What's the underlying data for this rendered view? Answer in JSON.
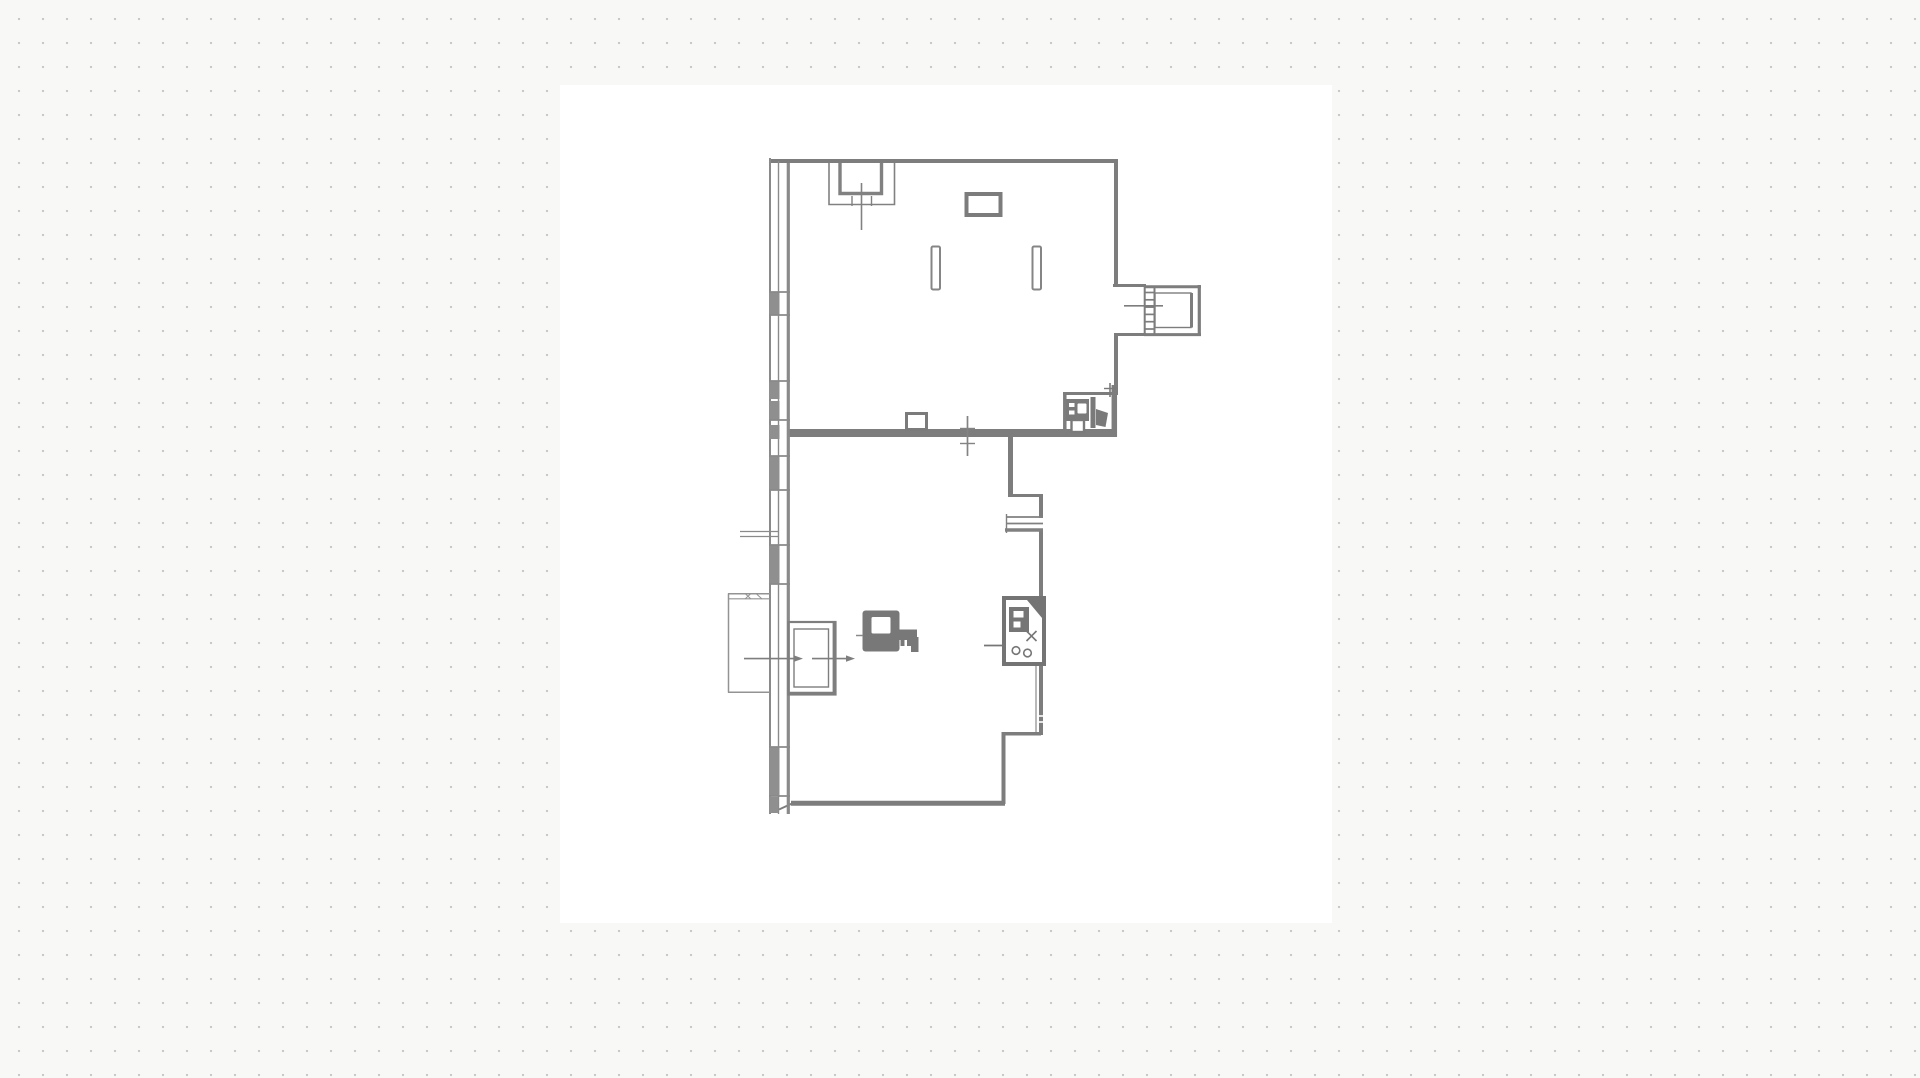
{
  "app": {
    "type": "design-canvas",
    "description": "Dotted-grid design canvas displaying a scanned architectural floor plan",
    "background_color": "#f8f8f7",
    "dot_color": "#c9c9c9",
    "dot_spacing_px": 24,
    "paper_color": "#ffffff",
    "line_color": "#828282"
  },
  "floor_plan": {
    "label": "Floor plan drawing of a two-room unit: upper hall with shaft, two columns and WC, lower room with kitchen unit, closet, toilet symbol, left window wall with glazing, left and right balcony boxes, vent grille and dimension markers",
    "rooms": [
      {
        "name": "upper-hall"
      },
      {
        "name": "lower-room"
      }
    ],
    "elements": [
      {
        "name": "window-wall",
        "side": "left",
        "glazing_segments": 6
      },
      {
        "name": "top-left-shaft"
      },
      {
        "name": "wall-shaft-box"
      },
      {
        "name": "column",
        "count": 2
      },
      {
        "name": "right-balcony-box"
      },
      {
        "name": "wc-fixtures",
        "items": [
          "sink",
          "toilet",
          "floor-box"
        ]
      },
      {
        "name": "dividing-wall"
      },
      {
        "name": "wall-mounted-box"
      },
      {
        "name": "vent-grille"
      },
      {
        "name": "kitchen-unit",
        "items": [
          "counter-glyph",
          "star-burner",
          "two-rings"
        ]
      },
      {
        "name": "closet-box"
      },
      {
        "name": "left-balcony"
      },
      {
        "name": "toilet-symbol"
      },
      {
        "name": "dimension-markers",
        "count": 5
      }
    ]
  }
}
